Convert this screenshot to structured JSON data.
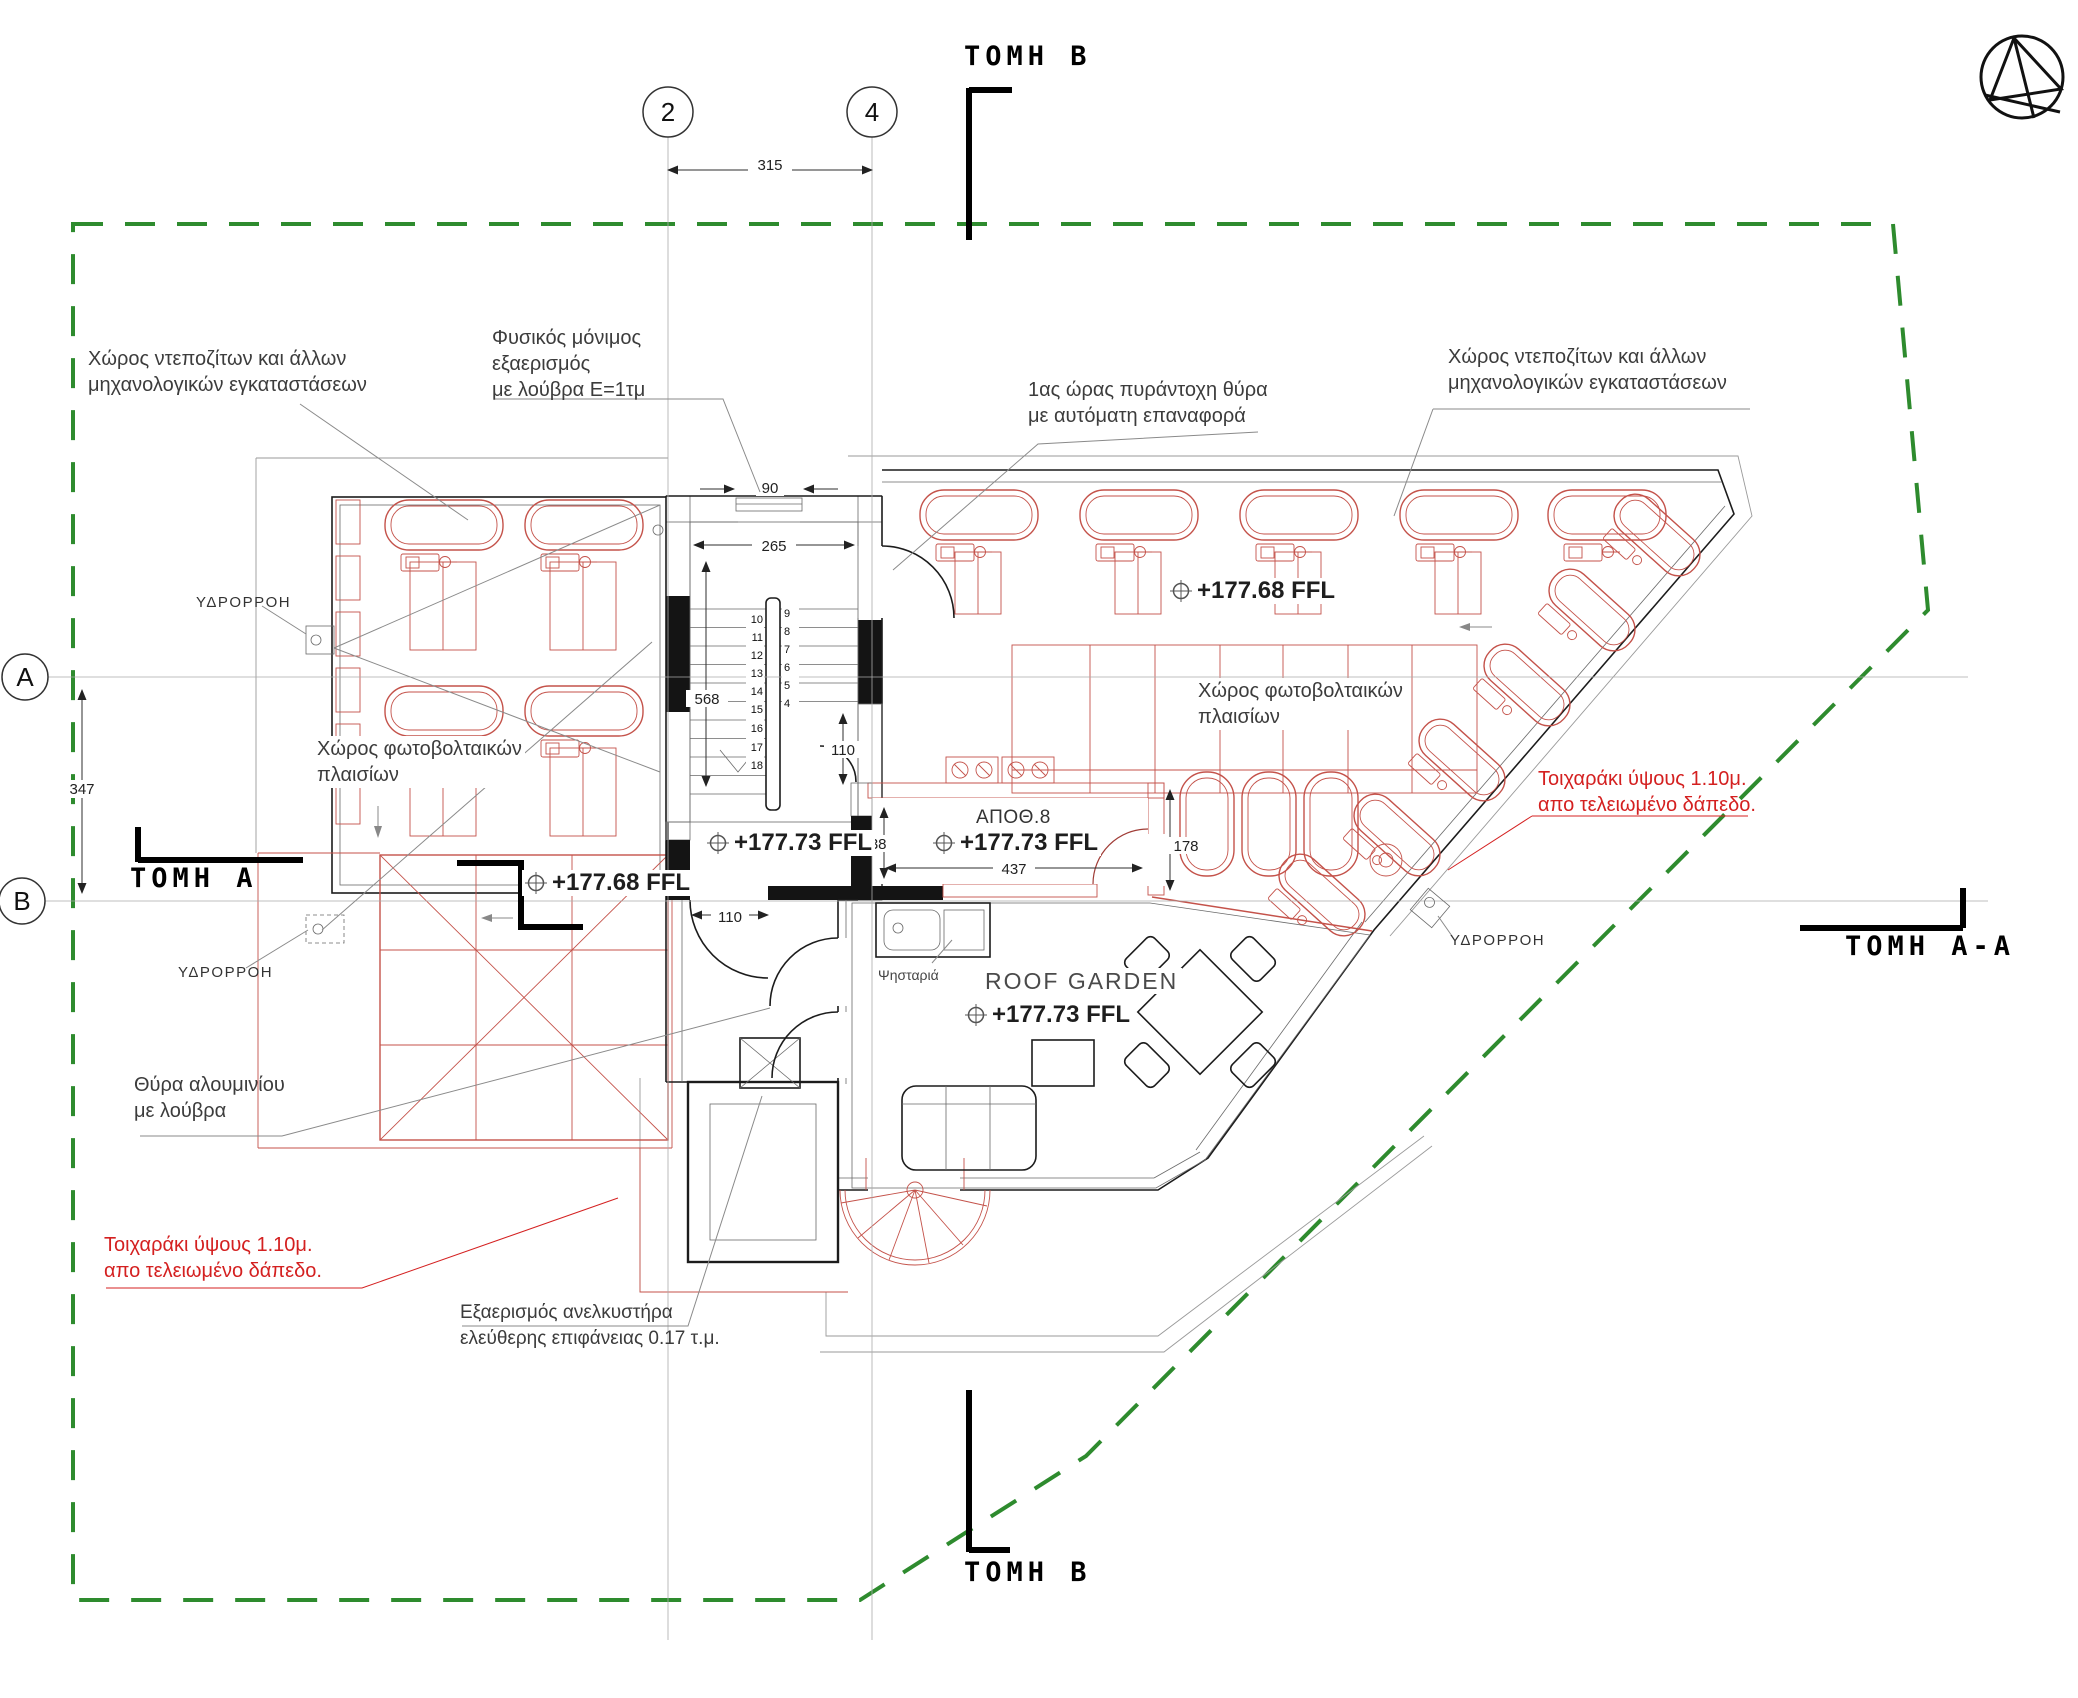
{
  "section_markers": {
    "top": "TOMH B",
    "bottom": "TOMH B",
    "left": "TOMH A",
    "right": "TOMH A-A"
  },
  "grid_axes": {
    "col_2": "2",
    "col_4": "4",
    "row_a": "A",
    "row_b": "B"
  },
  "dimensions": {
    "grid_span": "315",
    "row_span": "347",
    "louvre_opening": "90",
    "stair_width": "265",
    "stair_length": "568",
    "door_right": "110",
    "door_lobby": "110",
    "storage_length": "437",
    "storage_width": "138",
    "storage_side": "178"
  },
  "levels": {
    "left_roof": "+177.68 FFL",
    "right_roof": "+177.68 FFL",
    "lobby": "+177.73 FFL",
    "storage": "+177.73 FFL",
    "garden": "+177.73 FFL"
  },
  "rooms": {
    "storage": "ΑΠΟΘ.8",
    "roof_garden": "ROOF GARDEN",
    "bbq": "Ψησταριά"
  },
  "stair_numbers": {
    "right_flight": [
      "9",
      "8",
      "7",
      "6",
      "5",
      "4"
    ],
    "left_flight": [
      "10",
      "11",
      "12",
      "13",
      "14",
      "15",
      "16",
      "17",
      "18"
    ]
  },
  "annotations": {
    "deposits_left": {
      "line1": "Χώρος ντεποζίτων και άλλων",
      "line2": "μηχανολογικών εγκαταστάσεων"
    },
    "deposits_right": {
      "line1": "Χώρος ντεποζίτων και άλλων",
      "line2": "μηχανολογικών εγκαταστάσεων"
    },
    "natural_vent": {
      "line1": "Φυσικός μόνιμος",
      "line2": "εξαερισμός",
      "line3": "με λούβρα Ε=1τμ"
    },
    "fire_door": {
      "line1": "1ας ώρας πυράντοχη θύρα",
      "line2": "με αυτόματη επαναφορά"
    },
    "pv_right": {
      "line1": "Χώρος φωτοβολταικών",
      "line2": "πλαισίων"
    },
    "pv_left": {
      "line1": "Χώρος φωτοβολταικών",
      "line2": "πλαισίων"
    },
    "rain_outlet": "ΥΔΡΟΡΡΟΗ",
    "parapet": {
      "line1": "Τοιχαράκι ύψους 1.10μ.",
      "line2": "απο τελειωμένο δάπεδο."
    },
    "aluminum_door": {
      "line1": "Θύρα αλουμινίου",
      "line2": "με λούβρα"
    },
    "elevator_vent": {
      "line1": "Εξαερισμός ανελκυστήρα",
      "line2": "ελεύθερης επιφάνειας 0.17 τ.μ."
    }
  },
  "icons": {
    "north_arrow": "north-arrow",
    "level_target": "level-target-crosshair"
  },
  "colors": {
    "tank_red": "#c4524a",
    "annotation_red": "#d42020",
    "boundary_green": "#2e8b2e"
  }
}
